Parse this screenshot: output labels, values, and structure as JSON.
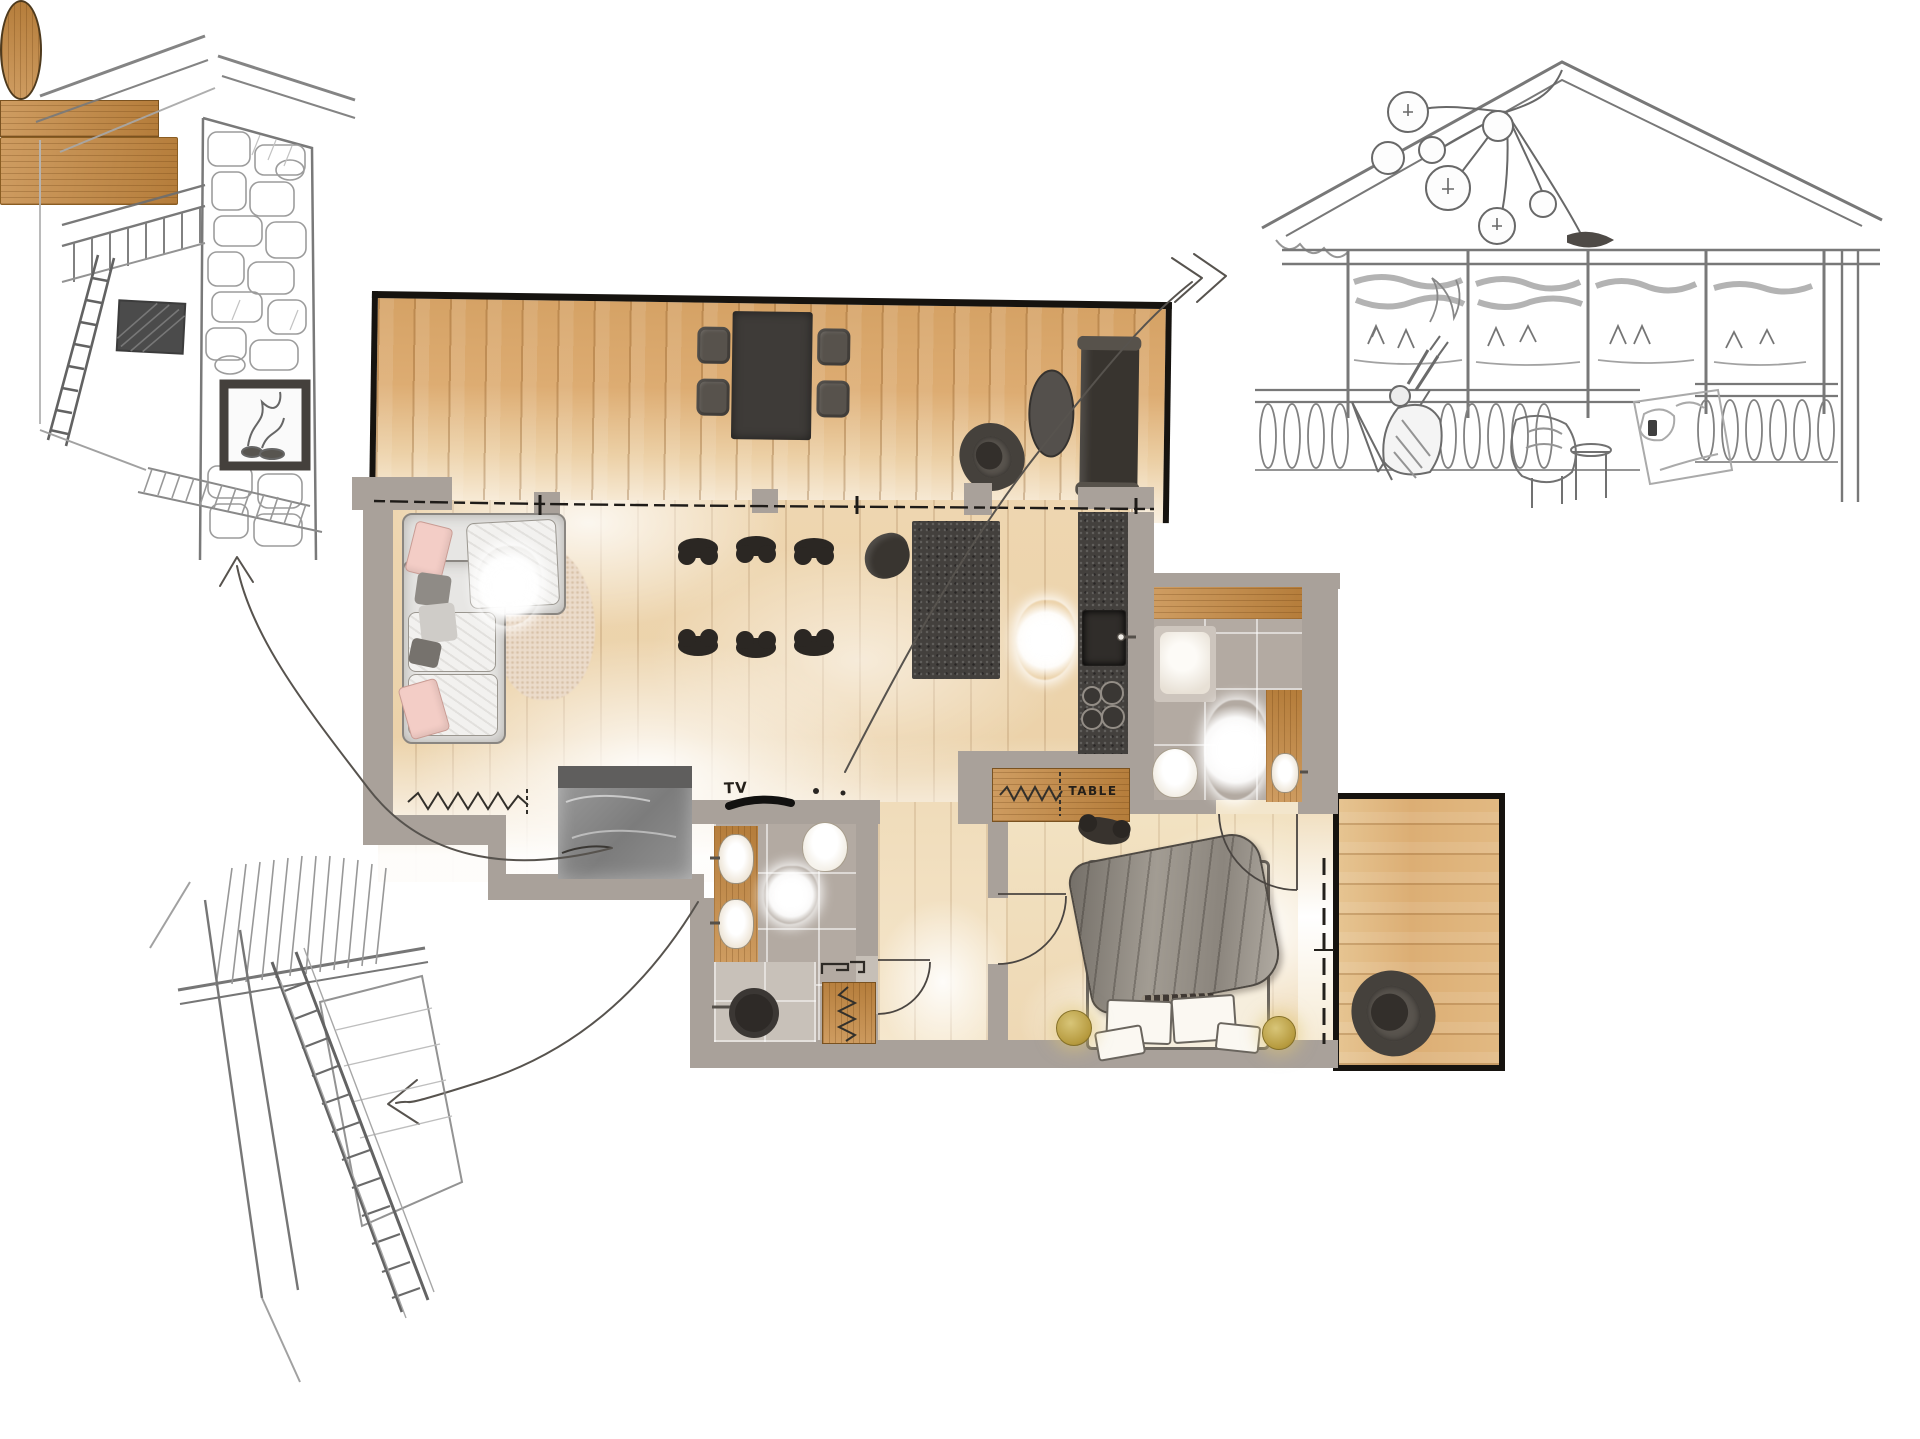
{
  "labels": {
    "tv": "TV",
    "table": "TABLE"
  },
  "palette": {
    "outline": "#16130f",
    "wall": "#a9a19a",
    "deck_wood": "#dcab72",
    "floor_wood": "#eed6b0",
    "balcony_wood": "#ddb07b",
    "furniture_wood": "#c4873f",
    "counter_stone": "#43403d",
    "tile": "#b3aaa2",
    "sofa": "#e7e6e4",
    "pink_pillow": "#f3cdc6",
    "duvet_gray": "#94908a",
    "lamp_gold": "#c3a94f",
    "marble_mat": "#8f8f8f",
    "sketch_line": "#6f6d6b",
    "arrow_line": "#57534e"
  },
  "rooms": [
    "terrace",
    "living-dining-room",
    "kitchen",
    "bathroom-top",
    "bathroom-bottom",
    "bedroom",
    "hallway",
    "balcony"
  ],
  "furniture": {
    "terrace": [
      "outdoor-dining-table",
      "outdoor-chairs",
      "barrel-lounge-chair",
      "oval-coffee-table",
      "hanging-bench"
    ],
    "living": [
      "corner-sofa",
      "fluffy-rug",
      "oval-side-table",
      "marble-mat",
      "zigzag-sideboard",
      "tv-console"
    ],
    "dining": [
      "wood-dining-table",
      "sculpted-chairs"
    ],
    "kitchen": [
      "island-counter",
      "wall-counter",
      "sink",
      "cooktop",
      "fluffy-rug",
      "decor-sculpture"
    ],
    "bathroom_top": [
      "wood-vanity",
      "shower",
      "toilet",
      "fluffy-rug",
      "washbasin"
    ],
    "bathroom_bottom": [
      "double-washbasin-vanity",
      "toilet",
      "shower",
      "zigzag-cabinet",
      "fluffy-plant"
    ],
    "bedroom": [
      "console-sideboard",
      "sculpted-chair",
      "double-bed",
      "pillows",
      "bedside-lamps"
    ],
    "balcony": [
      "barrel-lounge-chair"
    ]
  }
}
